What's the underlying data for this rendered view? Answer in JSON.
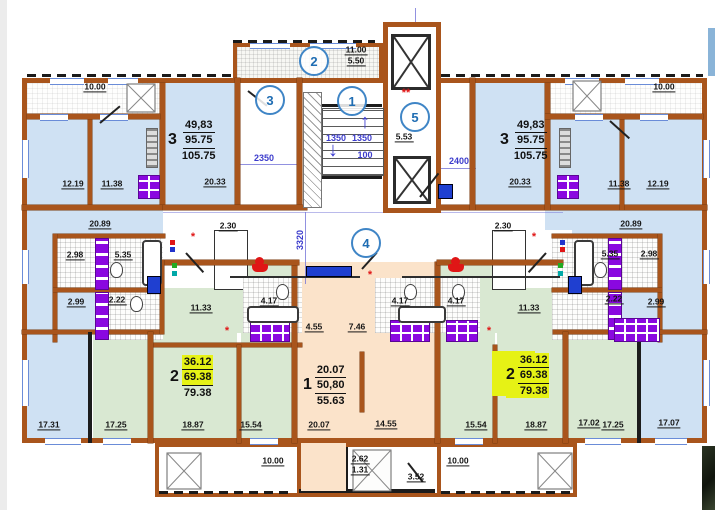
{
  "document": {
    "type": "residential-floor-plan"
  },
  "colors": {
    "wall_brown": "#a9551c",
    "room_blue": "#cfe1f3",
    "room_green": "#d9e8d2",
    "room_peach": "#fbe3ca",
    "highlight_yellow": "#e6f215",
    "fixture_purple": "#8a08e0",
    "marker_blue": "#3f85c6",
    "dim_blue": "#3c3ccc",
    "accent_red": "#e01616"
  },
  "apartments": [
    {
      "id": "apt3-left",
      "number": "3",
      "areas": [
        "49,83",
        "95.75",
        "105.75"
      ],
      "x": 168,
      "y": 118,
      "hl": "none"
    },
    {
      "id": "apt3-right",
      "number": "3",
      "areas": [
        "49,83",
        "95.75",
        "105.75"
      ],
      "x": 500,
      "y": 118,
      "hl": "none"
    },
    {
      "id": "apt2-left",
      "number": "2",
      "areas": [
        "36.12",
        "69.38",
        "79.38"
      ],
      "x": 170,
      "y": 355,
      "hl": "rows"
    },
    {
      "id": "apt1-center",
      "number": "1",
      "areas": [
        "20.07",
        "50,80",
        "55.63"
      ],
      "x": 303,
      "y": 363,
      "hl": "none"
    },
    {
      "id": "apt2-right",
      "number": "2",
      "areas": [
        "36.12",
        "69.38",
        "79.38"
      ],
      "x": 506,
      "y": 353,
      "hl": "block"
    }
  ],
  "room_labels": [
    {
      "t": "10.00",
      "x": 95,
      "y": 87
    },
    {
      "t": "12.19",
      "x": 73,
      "y": 184
    },
    {
      "t": "11.38",
      "x": 112,
      "y": 184
    },
    {
      "t": "20.33",
      "x": 215,
      "y": 182
    },
    {
      "t": "11.00",
      "x": 356,
      "y": 50
    },
    {
      "t": "5.50",
      "x": 356,
      "y": 61
    },
    {
      "t": "5.53",
      "x": 404,
      "y": 137
    },
    {
      "t": "10.00",
      "x": 664,
      "y": 87
    },
    {
      "t": "20.33",
      "x": 520,
      "y": 182
    },
    {
      "t": "11.38",
      "x": 619,
      "y": 184
    },
    {
      "t": "12.19",
      "x": 658,
      "y": 184
    },
    {
      "t": "20.89",
      "x": 100,
      "y": 224
    },
    {
      "t": "2.30",
      "x": 228,
      "y": 226
    },
    {
      "t": "2.98",
      "x": 75,
      "y": 255
    },
    {
      "t": "5.35",
      "x": 123,
      "y": 255
    },
    {
      "t": "2.22",
      "x": 117,
      "y": 300
    },
    {
      "t": "2.99",
      "x": 76,
      "y": 302
    },
    {
      "t": "11.33",
      "x": 201,
      "y": 308
    },
    {
      "t": "20.89",
      "x": 631,
      "y": 224
    },
    {
      "t": "2.30",
      "x": 503,
      "y": 226
    },
    {
      "t": "5.35",
      "x": 610,
      "y": 254
    },
    {
      "t": "2.98",
      "x": 649,
      "y": 254
    },
    {
      "t": "2.22",
      "x": 614,
      "y": 299
    },
    {
      "t": "2.99",
      "x": 656,
      "y": 302
    },
    {
      "t": "11.33",
      "x": 529,
      "y": 308
    },
    {
      "t": "4.17",
      "x": 269,
      "y": 301
    },
    {
      "t": "4.17",
      "x": 400,
      "y": 301
    },
    {
      "t": "4.17",
      "x": 456,
      "y": 301
    },
    {
      "t": "4.55",
      "x": 314,
      "y": 327
    },
    {
      "t": "7.46",
      "x": 357,
      "y": 327
    },
    {
      "t": "17.31",
      "x": 49,
      "y": 425
    },
    {
      "t": "17.25",
      "x": 116,
      "y": 425
    },
    {
      "t": "18.87",
      "x": 193,
      "y": 425
    },
    {
      "t": "15.54",
      "x": 251,
      "y": 425
    },
    {
      "t": "20.07",
      "x": 319,
      "y": 425
    },
    {
      "t": "14.55",
      "x": 386,
      "y": 424
    },
    {
      "t": "15.54",
      "x": 476,
      "y": 425
    },
    {
      "t": "18.87",
      "x": 536,
      "y": 425
    },
    {
      "t": "17.02",
      "x": 589,
      "y": 423
    },
    {
      "t": "17.25",
      "x": 613,
      "y": 425
    },
    {
      "t": "17.07",
      "x": 669,
      "y": 423
    },
    {
      "t": "10.00",
      "x": 273,
      "y": 461
    },
    {
      "t": "2.62",
      "x": 360,
      "y": 459
    },
    {
      "t": "1.31",
      "x": 360,
      "y": 470
    },
    {
      "t": "3.52",
      "x": 416,
      "y": 477
    },
    {
      "t": "10.00",
      "x": 458,
      "y": 461
    }
  ],
  "dim_labels": [
    {
      "t": "2350",
      "x": 264,
      "y": 158,
      "rot": false
    },
    {
      "t": "2400",
      "x": 459,
      "y": 161,
      "rot": false
    },
    {
      "t": "1350",
      "x": 336,
      "y": 138,
      "rot": false
    },
    {
      "t": "1350",
      "x": 362,
      "y": 138,
      "rot": false
    },
    {
      "t": "100",
      "x": 365,
      "y": 155,
      "rot": false
    },
    {
      "t": "3320",
      "x": 300,
      "y": 240,
      "rot": true
    }
  ],
  "markers": [
    {
      "n": "2",
      "x": 314,
      "y": 61
    },
    {
      "n": "3",
      "x": 270,
      "y": 100
    },
    {
      "n": "1",
      "x": 352,
      "y": 101
    },
    {
      "n": "5",
      "x": 415,
      "y": 117
    },
    {
      "n": "4",
      "x": 366,
      "y": 243
    }
  ],
  "red_marks": [
    {
      "t": "**",
      "x": 406,
      "y": 93
    },
    {
      "t": "*",
      "x": 193,
      "y": 237
    },
    {
      "t": "*",
      "x": 534,
      "y": 237
    },
    {
      "t": "*",
      "x": 370,
      "y": 275
    },
    {
      "t": "*",
      "x": 227,
      "y": 331
    },
    {
      "t": "*",
      "x": 489,
      "y": 331
    }
  ],
  "indicator_dots": [
    {
      "x": 170,
      "y": 240,
      "c": "#e01616"
    },
    {
      "x": 170,
      "y": 247,
      "c": "#2233cc"
    },
    {
      "x": 172,
      "y": 263,
      "c": "#22aa22"
    },
    {
      "x": 172,
      "y": 271,
      "c": "#00a8a8"
    },
    {
      "x": 560,
      "y": 240,
      "c": "#2233cc"
    },
    {
      "x": 560,
      "y": 247,
      "c": "#e01616"
    },
    {
      "x": 558,
      "y": 263,
      "c": "#22aa22"
    },
    {
      "x": 558,
      "y": 271,
      "c": "#00a8a8"
    }
  ],
  "stair_arrows": {
    "down": "↓",
    "up": "↑"
  }
}
